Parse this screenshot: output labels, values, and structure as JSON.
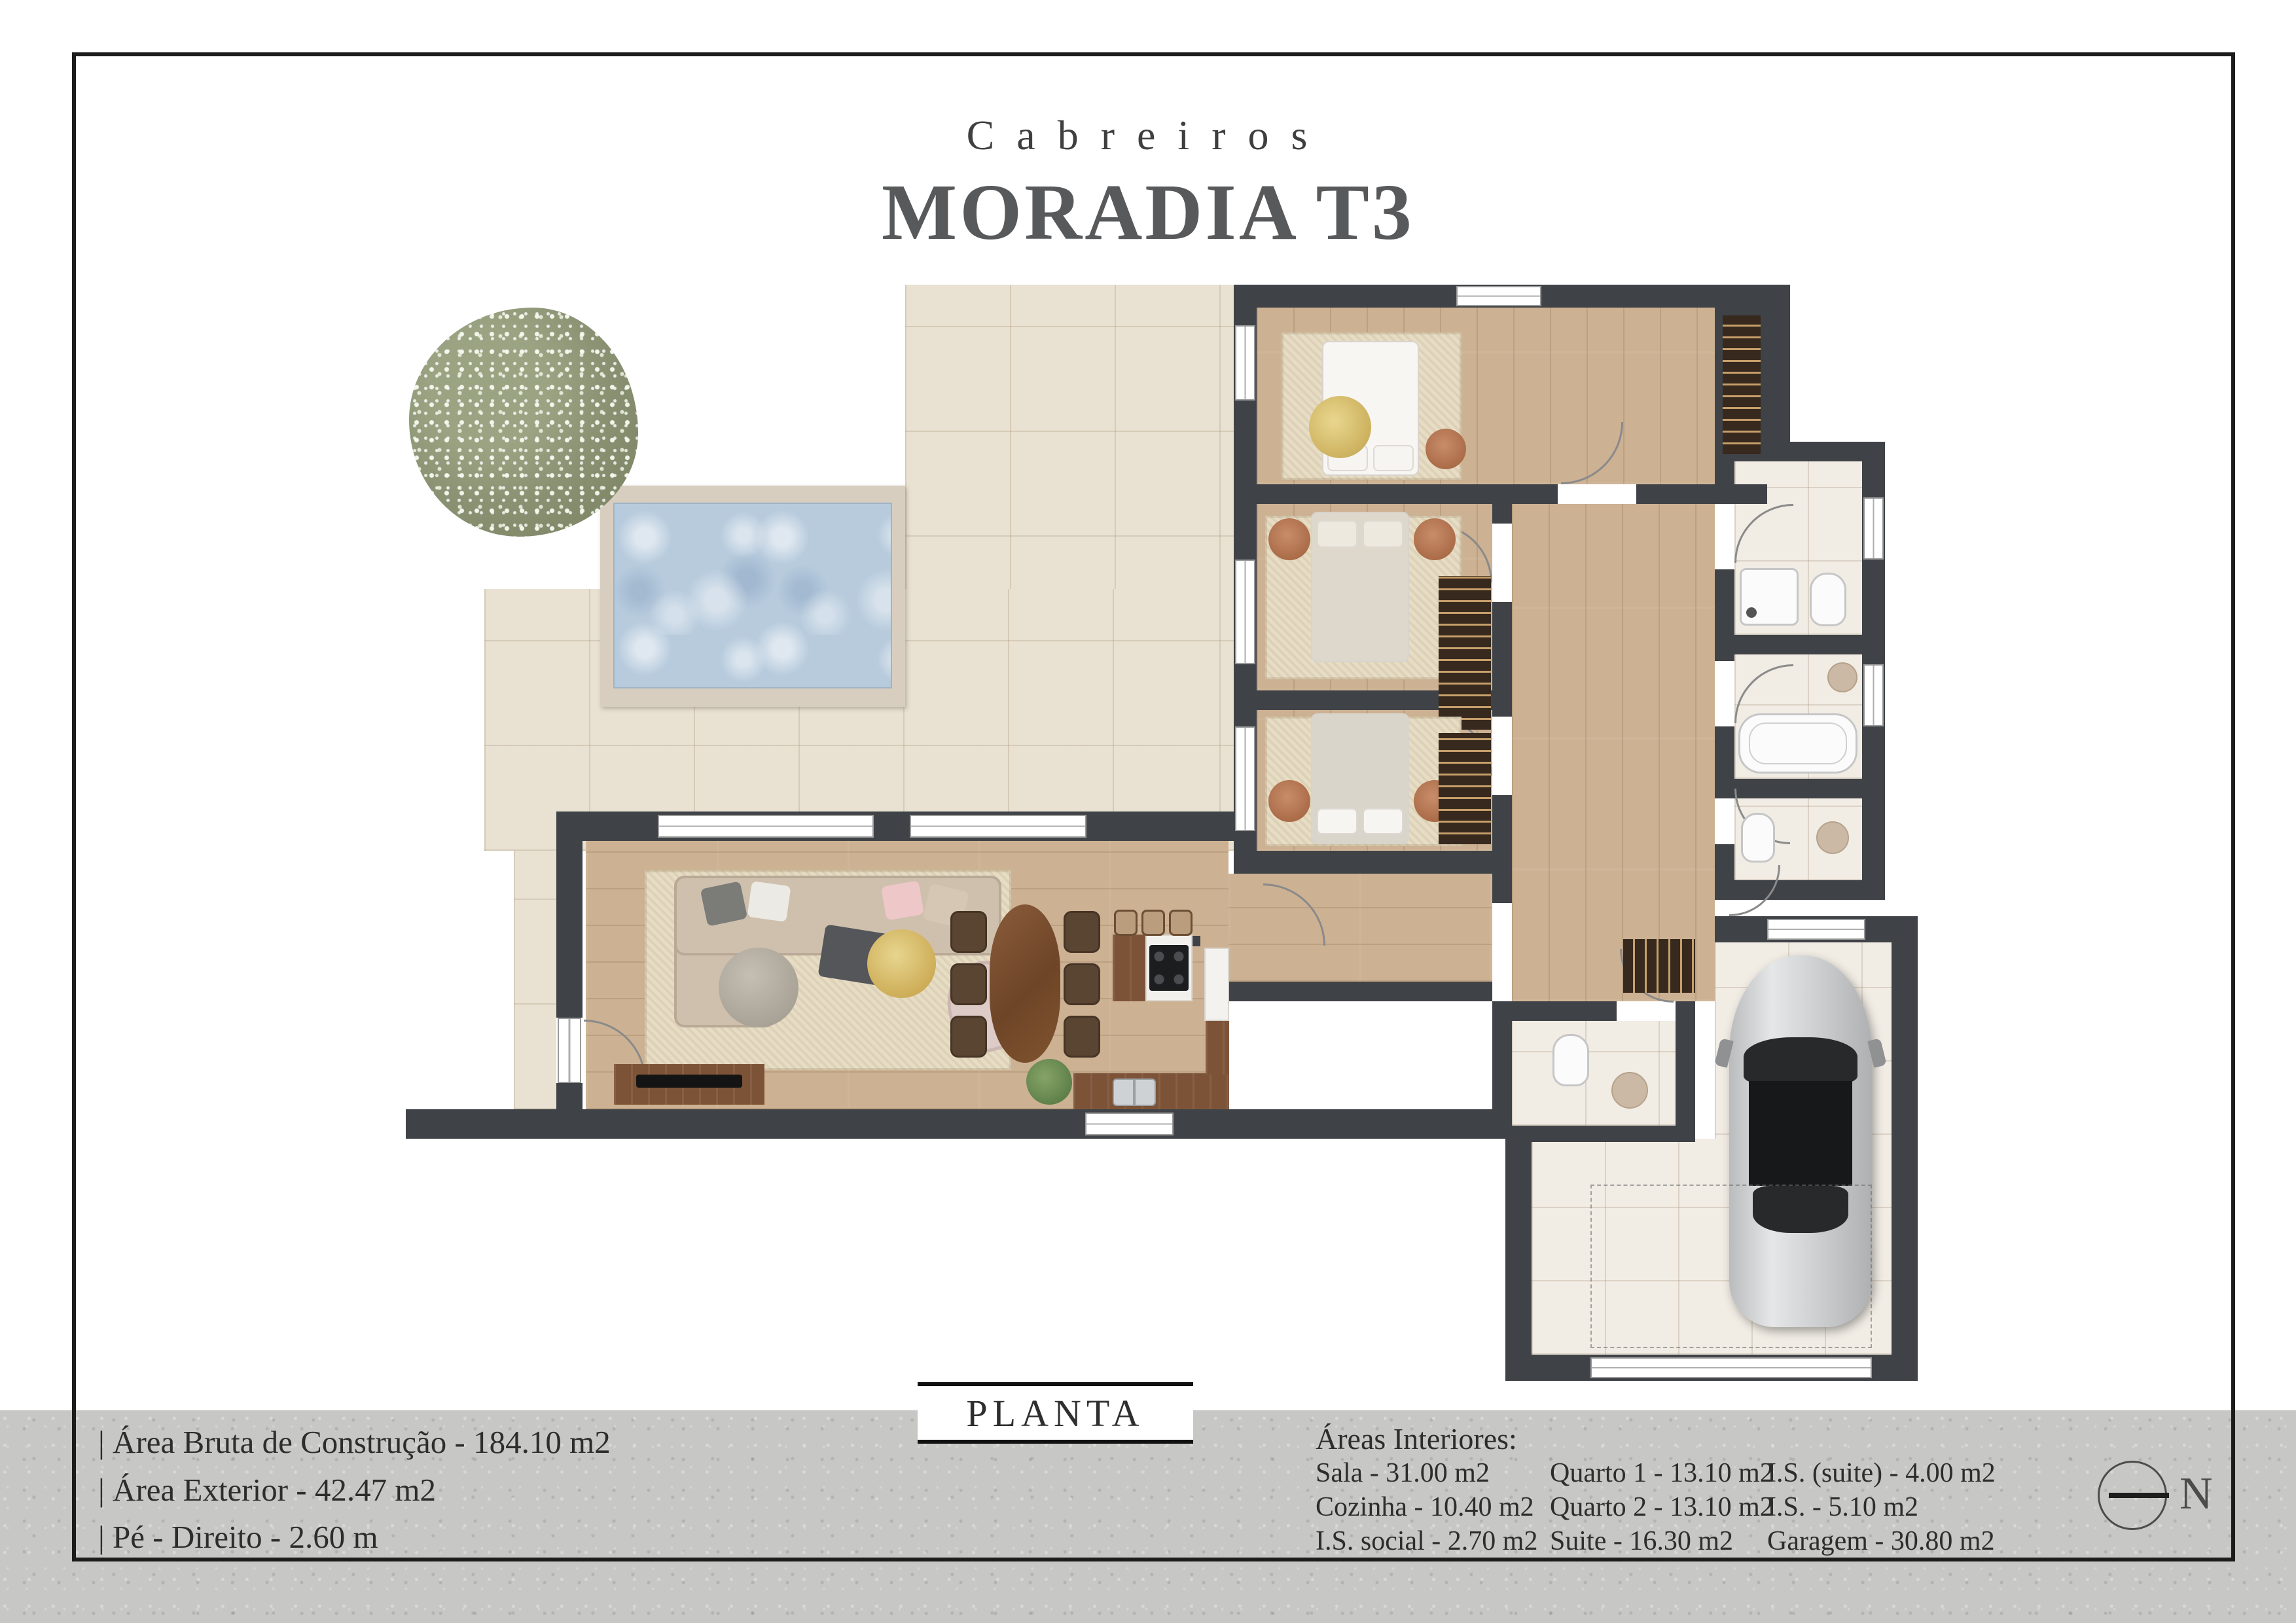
{
  "header": {
    "brand": "Cabreiros",
    "title": "MORADIA T3"
  },
  "plate": {
    "label": "PLANTA"
  },
  "specs": {
    "items": [
      "|  Área Bruta de Construção - 184.10 m2",
      "|  Área Exterior - 42.47 m2",
      "|  Pé - Direito - 2.60 m"
    ]
  },
  "areas": {
    "heading": "Áreas Interiores:",
    "col1": [
      "Sala - 31.00 m2",
      "Cozinha - 10.40 m2",
      "I.S. social - 2.70 m2"
    ],
    "col2": [
      "Quarto 1 - 13.10 m2",
      "Quarto 2 - 13.10 m2",
      "Suite - 16.30 m2"
    ],
    "col3": [
      "I.S. (suite) - 4.00 m2",
      "I.S. - 5.10 m2",
      "Garagem - 30.80 m2"
    ]
  },
  "compass": {
    "label": "N"
  },
  "palette": {
    "wall": "#3f4347",
    "wood_floor": "#cdb193",
    "terrace_tile": "#e9e1d2",
    "bath_tile": "#f1ece4",
    "pool_water": "#b7cbdd",
    "pool_deck": "#d8cec0",
    "tree_foliage": "#8a9273",
    "car_body": "#c9cbcd",
    "frame": "#1c1c1c",
    "band": "#c7c7c5"
  }
}
